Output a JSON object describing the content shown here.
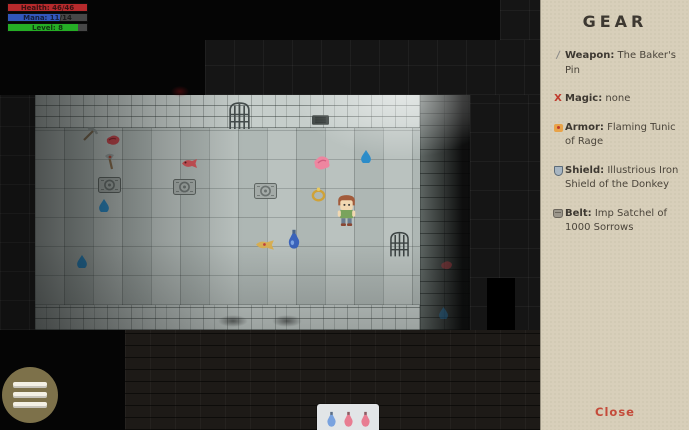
{
  "hud": {
    "health_label": "Health: 46/46",
    "mana_label": "Mana: 11/14",
    "level_label": "Level: 8",
    "colors": {
      "health": "#b62a2c",
      "mana": "#3157bb",
      "level": "#25ad25"
    }
  },
  "gear_panel": {
    "title": "GEAR",
    "items": [
      {
        "name": "weapon",
        "icon": "pin-weapon-icon",
        "icon_glyph": "/",
        "label": "Weapon:",
        "value": "The Baker's Pin"
      },
      {
        "name": "magic",
        "icon": "red-x-icon",
        "icon_glyph": "X",
        "label": "Magic:",
        "value": "none"
      },
      {
        "name": "armor",
        "icon": "tunic-icon",
        "label": "Armor:",
        "value": "Flaming Tunic of Rage"
      },
      {
        "name": "shield",
        "icon": "iron-shield-icon",
        "label": "Shield:",
        "value": "Illustrious Iron Shield of the Donkey"
      },
      {
        "name": "belt",
        "icon": "satchel-icon",
        "label": "Belt:",
        "value": "Imp Satchel of 1000 Sorrows"
      }
    ],
    "close_label": "Close",
    "bg_color": "#d8cfba",
    "accent_color": "#c44b3a"
  },
  "menu_button": {
    "icon": "hamburger-menu-icon",
    "color": "#7d714a"
  },
  "quickslot": {
    "potions": [
      "blue-potion-icon",
      "pink-potion-icon",
      "pink-potion-icon"
    ]
  },
  "map_items": [
    "pickaxe-icon",
    "raw-meat-icon",
    "axe-icon",
    "red-fish-icon",
    "grate-plate-icon",
    "grate-plate-icon",
    "grate-plate-icon",
    "water-drop-icon",
    "portcullis-gate-icon",
    "wall-vent-icon",
    "pink-meat-icon",
    "water-drop-icon",
    "gold-ring-icon",
    "player-character",
    "cooked-fish-icon",
    "blue-potion-icon",
    "water-drop-icon",
    "portcullis-gate-icon",
    "red-item-icon",
    "water-drop-icon",
    "blood-smudge"
  ]
}
